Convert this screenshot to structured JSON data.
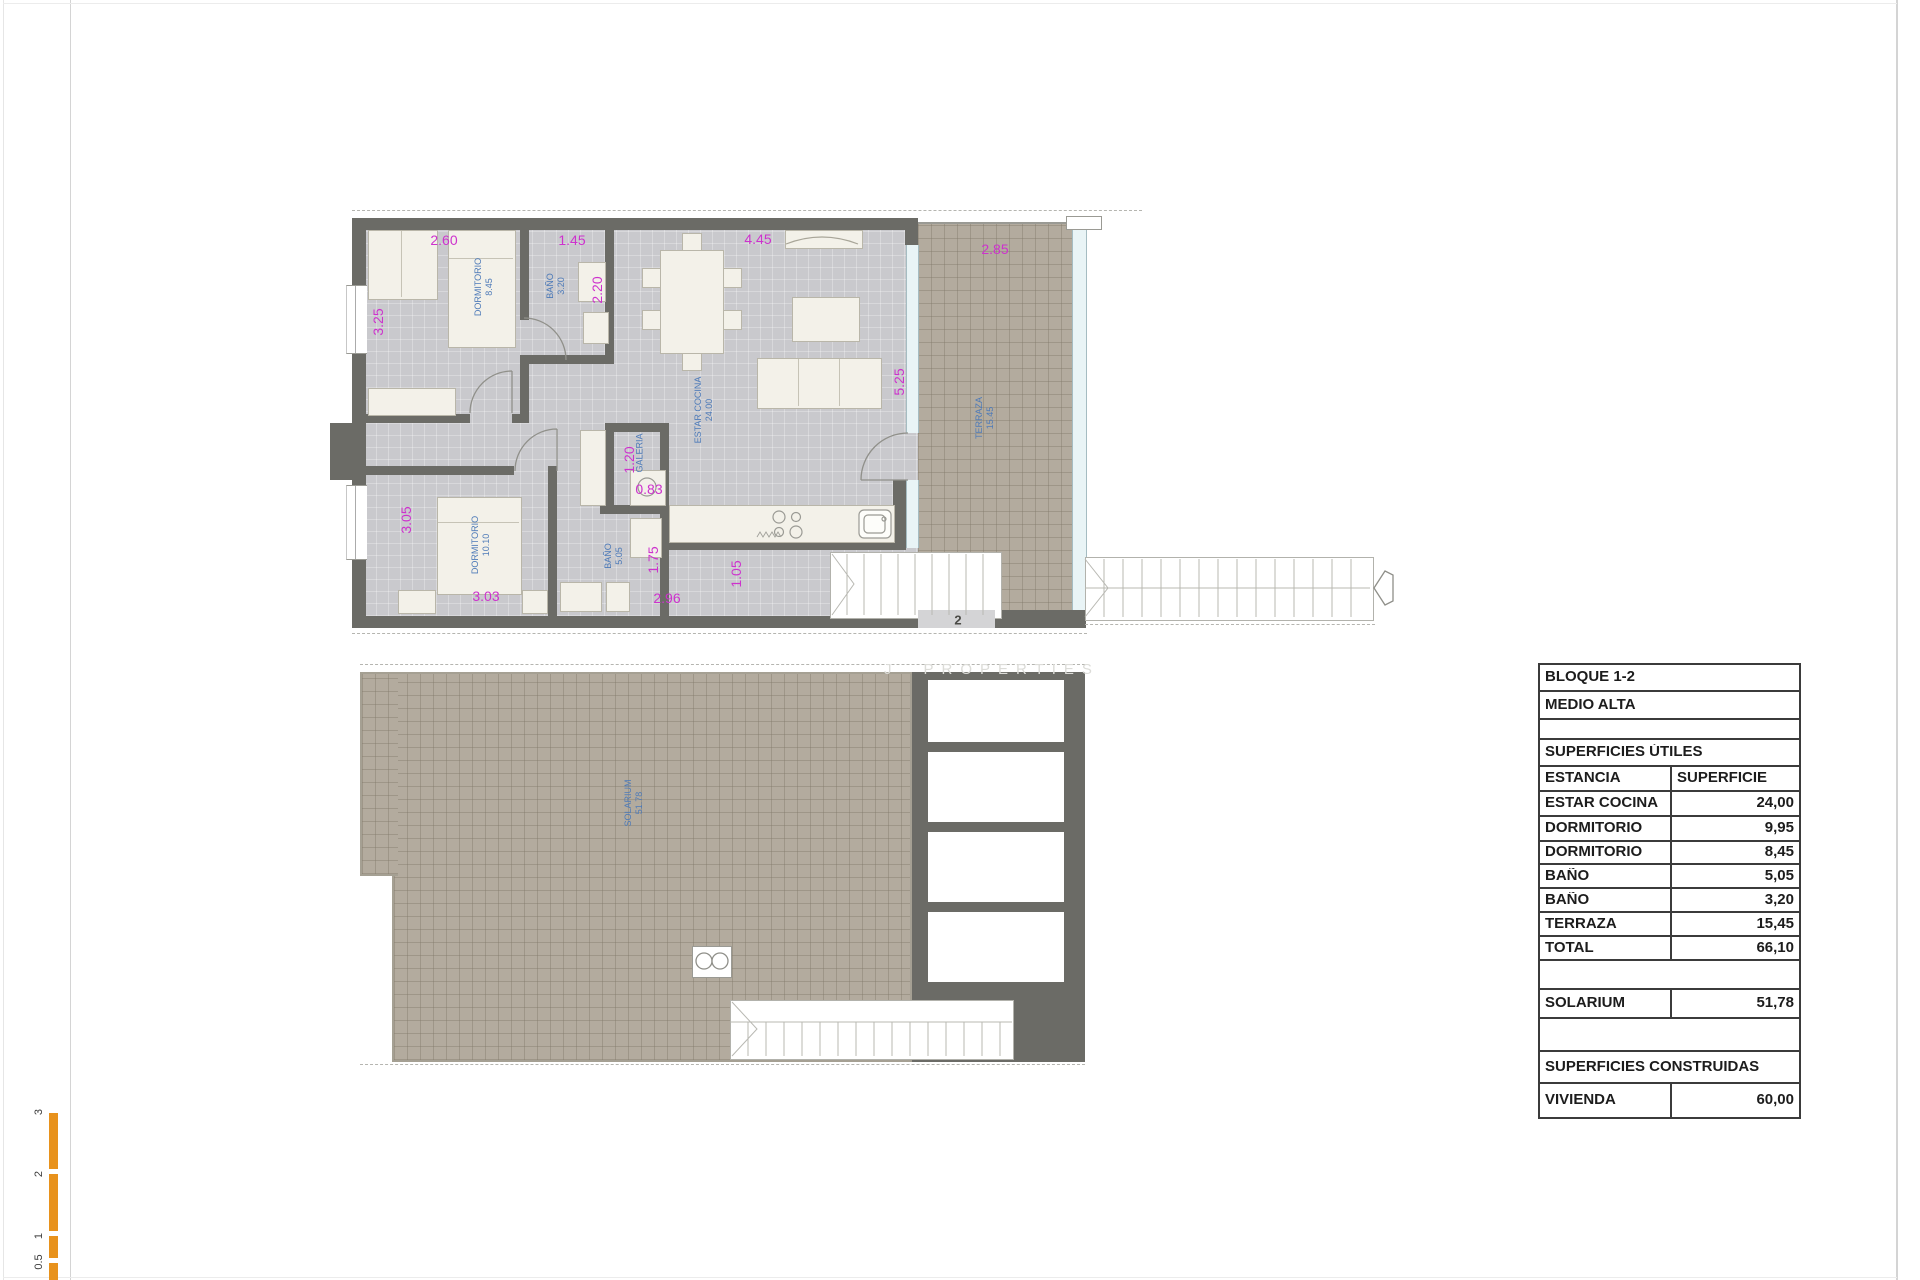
{
  "watermark": {
    "prefix": "J",
    "text": "PROPERTIES"
  },
  "scale_bar": {
    "labels": [
      "3",
      "2",
      "1",
      "0.5"
    ]
  },
  "entry_number": "2",
  "colors": {
    "wall": "#6b6b66",
    "floor": "#c9c9cd",
    "terrace": "#b3ab9e",
    "dimension": "#cd32cd",
    "room_label": "#4d7ab8",
    "scale_bar": "#e8921c"
  },
  "dims": [
    {
      "text": "2.60"
    },
    {
      "text": "1.45"
    },
    {
      "text": "4.45"
    },
    {
      "text": "2.85"
    },
    {
      "text": "3.25"
    },
    {
      "text": "2.20"
    },
    {
      "text": "5.25"
    },
    {
      "text": "1.20"
    },
    {
      "text": "0.83"
    },
    {
      "text": "3.05"
    },
    {
      "text": "1.75"
    },
    {
      "text": "1.05"
    },
    {
      "text": "3.03"
    },
    {
      "text": "2.96"
    }
  ],
  "rooms": [
    {
      "name": "DORMITORIO",
      "value": "8.45"
    },
    {
      "name": "BAÑO",
      "value": "3.20"
    },
    {
      "name": "ESTAR COCINA",
      "value": "24.00"
    },
    {
      "name": "GALERIA",
      "value": ""
    },
    {
      "name": "DORMITORIO",
      "value": "10.10"
    },
    {
      "name": "BAÑO",
      "value": "5.05"
    },
    {
      "name": "TERRAZA",
      "value": "15.45"
    },
    {
      "name": "SOLARIUM",
      "value": "51.78"
    }
  ],
  "table": {
    "rows": [
      {
        "label": "BLOQUE 1-2",
        "value": null
      },
      {
        "label": "MEDIO ALTA",
        "value": null
      },
      {
        "label": "",
        "value": null
      },
      {
        "label": "SUPERFICIES ÚTILES",
        "value": null
      },
      {
        "label": "ESTANCIA",
        "value": "SUPERFICIE"
      },
      {
        "label": "ESTAR COCINA",
        "value": "24,00"
      },
      {
        "label": "DORMITORIO",
        "value": "9,95"
      },
      {
        "label": "DORMITORIO",
        "value": "8,45"
      },
      {
        "label": "BAÑO",
        "value": "5,05"
      },
      {
        "label": "BAÑO",
        "value": "3,20"
      },
      {
        "label": "TERRAZA",
        "value": "15,45"
      },
      {
        "label": "TOTAL",
        "value": "66,10"
      },
      {
        "label": "",
        "value": null
      },
      {
        "label": "SOLARIUM",
        "value": "51,78"
      },
      {
        "label": "",
        "value": null
      },
      {
        "label": "SUPERFICIES CONSTRUIDAS",
        "value": null
      },
      {
        "label": "VIVIENDA",
        "value": "60,00"
      }
    ]
  }
}
